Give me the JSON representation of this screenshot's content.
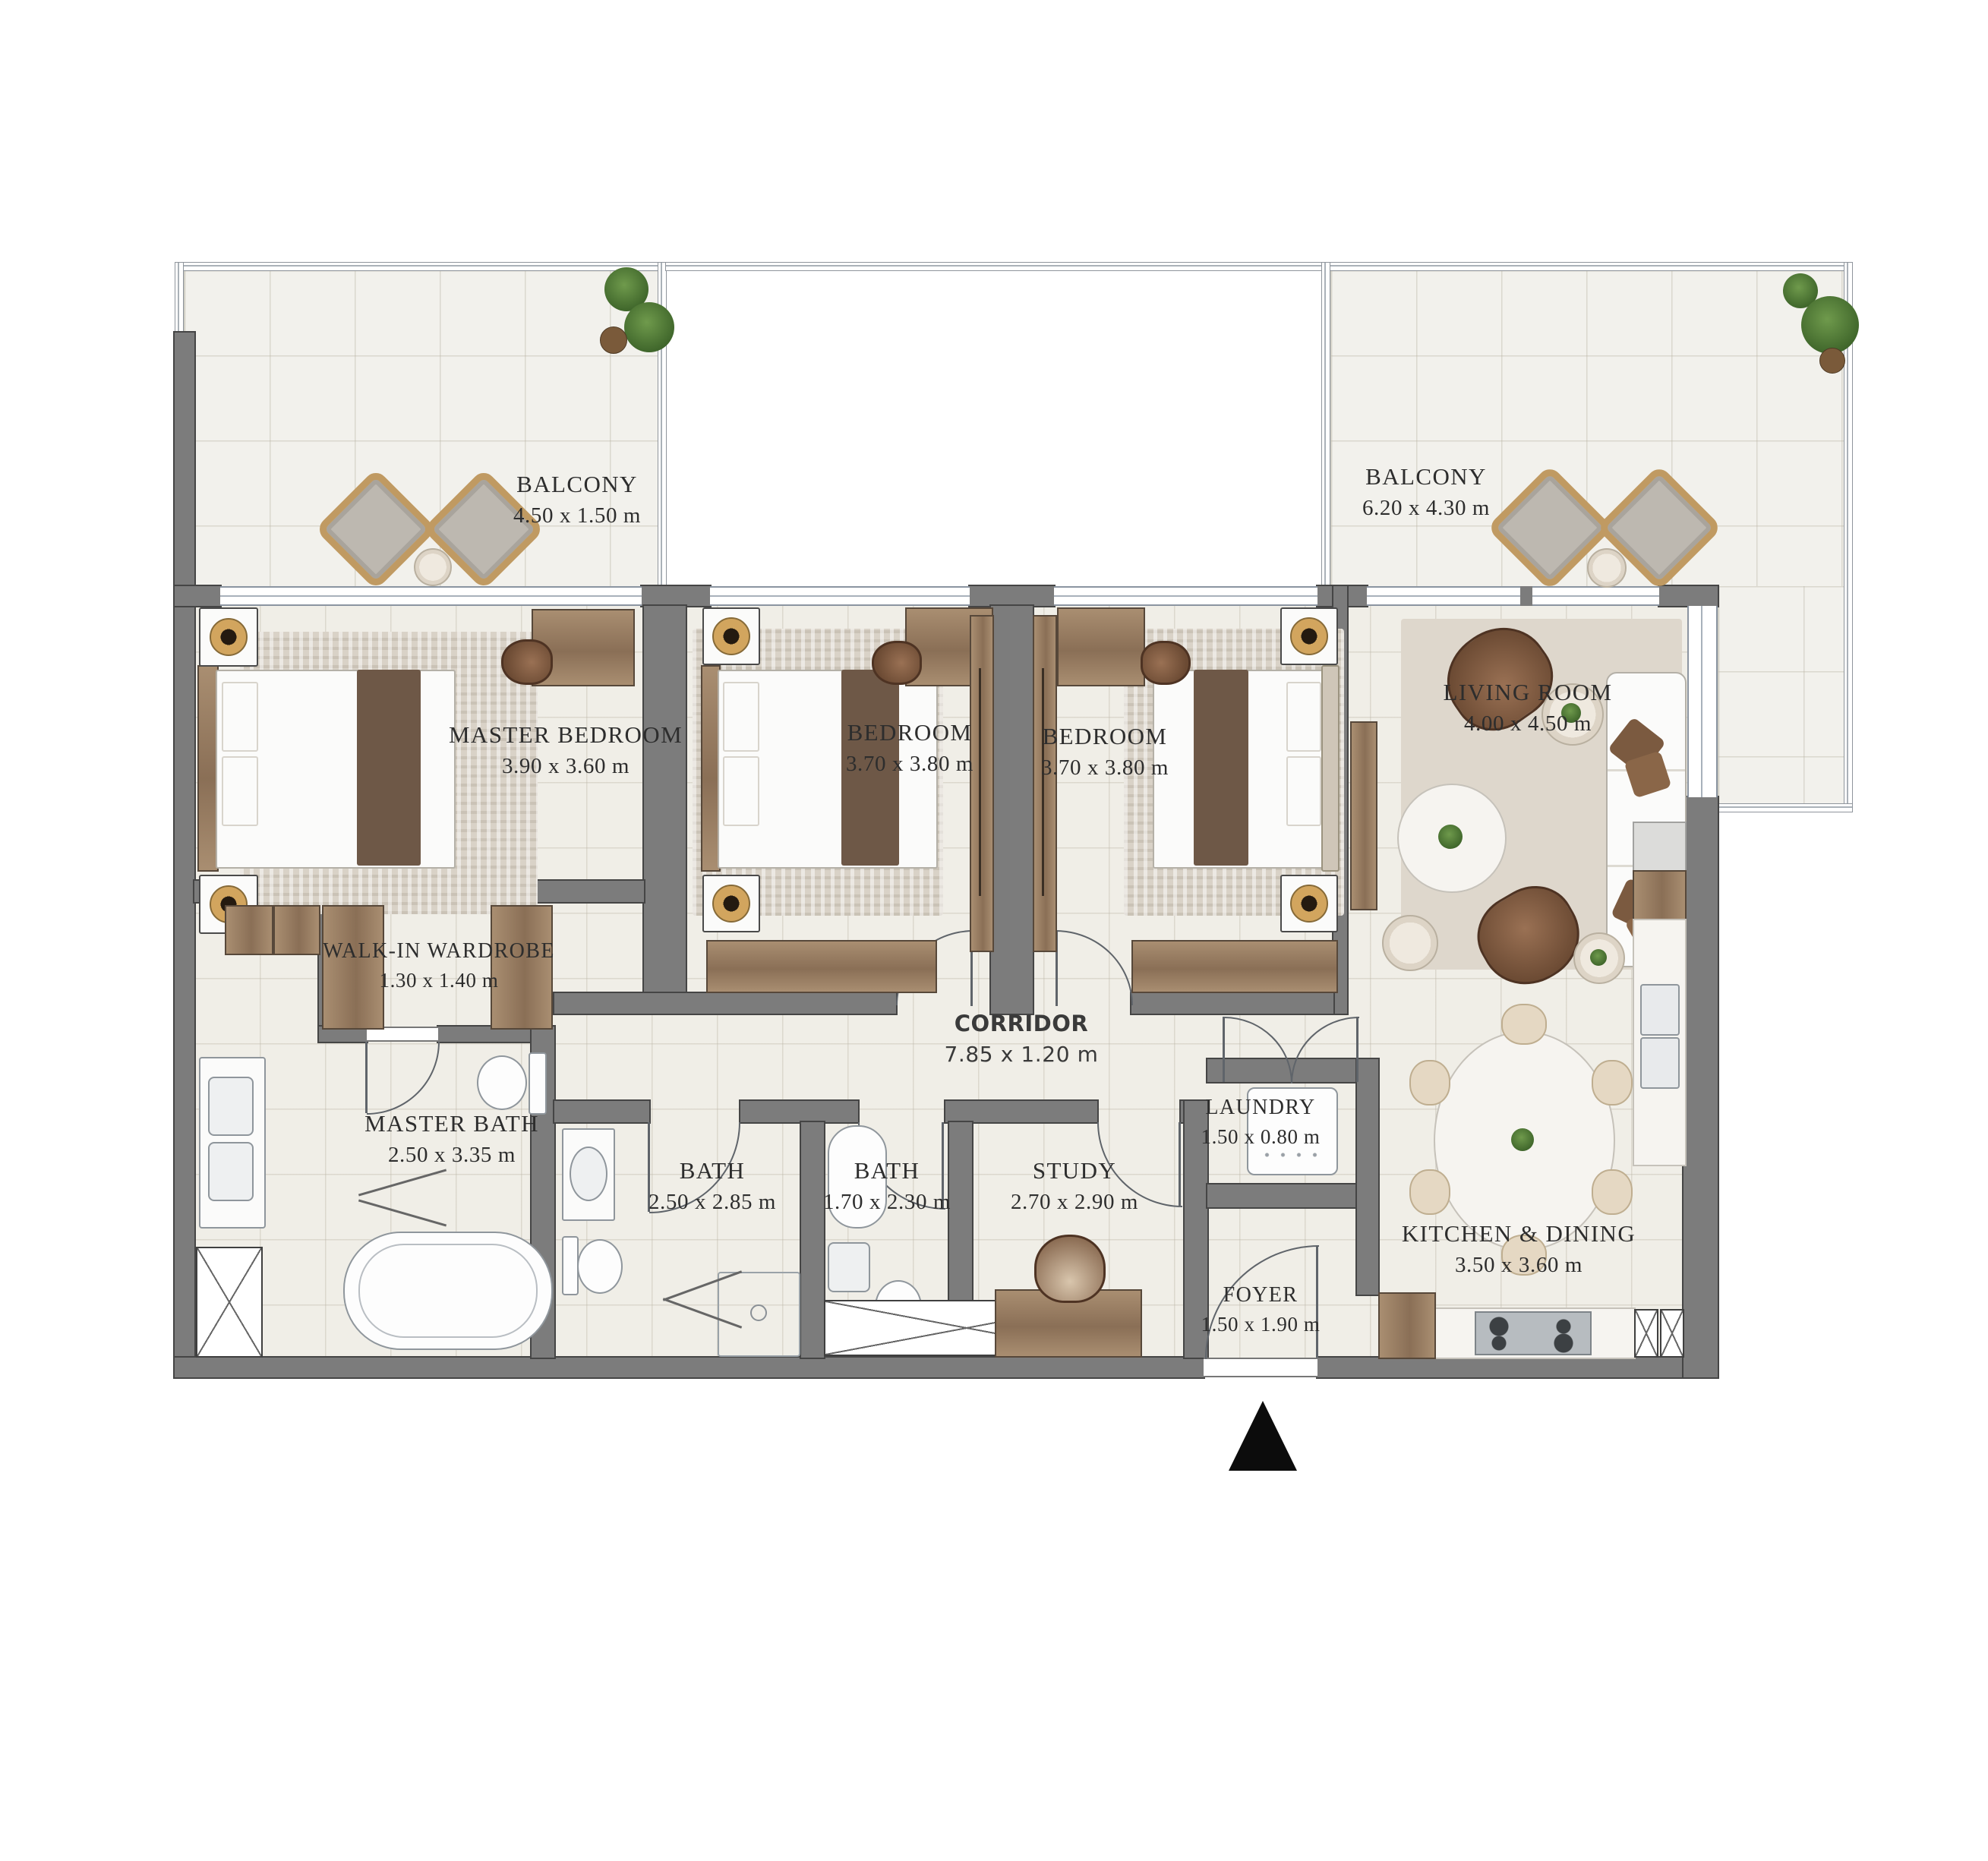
{
  "rooms": [
    {
      "id": "balcony-left",
      "name": "BALCONY",
      "dims": "4.50 x 1.50 m"
    },
    {
      "id": "balcony-right",
      "name": "BALCONY",
      "dims": "6.20 x 4.30 m"
    },
    {
      "id": "master-bedroom",
      "name": "MASTER BEDROOM",
      "dims": "3.90 x 3.60 m"
    },
    {
      "id": "bedroom-1",
      "name": "BEDROOM",
      "dims": "3.70 x 3.80 m"
    },
    {
      "id": "bedroom-2",
      "name": "BEDROOM",
      "dims": "3.70 x 3.80 m"
    },
    {
      "id": "living-room",
      "name": "LIVING ROOM",
      "dims": "4.00 x 4.50 m"
    },
    {
      "id": "walk-in-wardrobe",
      "name": "WALK-IN WARDROBE",
      "dims": "1.30 x 1.40 m"
    },
    {
      "id": "corridor",
      "name": "CORRIDOR",
      "dims": "7.85 x 1.20 m"
    },
    {
      "id": "master-bath",
      "name": "MASTER BATH",
      "dims": "2.50 x 3.35 m"
    },
    {
      "id": "bath-1",
      "name": "BATH",
      "dims": "2.50 x 2.85 m"
    },
    {
      "id": "bath-2",
      "name": "BATH",
      "dims": "1.70 x 2.30 m"
    },
    {
      "id": "study",
      "name": "STUDY",
      "dims": "2.70 x 2.90 m"
    },
    {
      "id": "laundry",
      "name": "LAUNDRY",
      "dims": "1.50 x 0.80 m"
    },
    {
      "id": "kitchen-dining",
      "name": "KITCHEN & DINING",
      "dims": "3.50 x 3.60 m"
    },
    {
      "id": "foyer",
      "name": "FOYER",
      "dims": "1.50 x 1.90 m"
    }
  ],
  "colors": {
    "wall": "#7c7c7c",
    "floor": "#f0eee7",
    "wood": "#9b8165",
    "rug": "#d9d2c7",
    "label": "#2e2e2e",
    "entrance_marker": "#000000"
  }
}
